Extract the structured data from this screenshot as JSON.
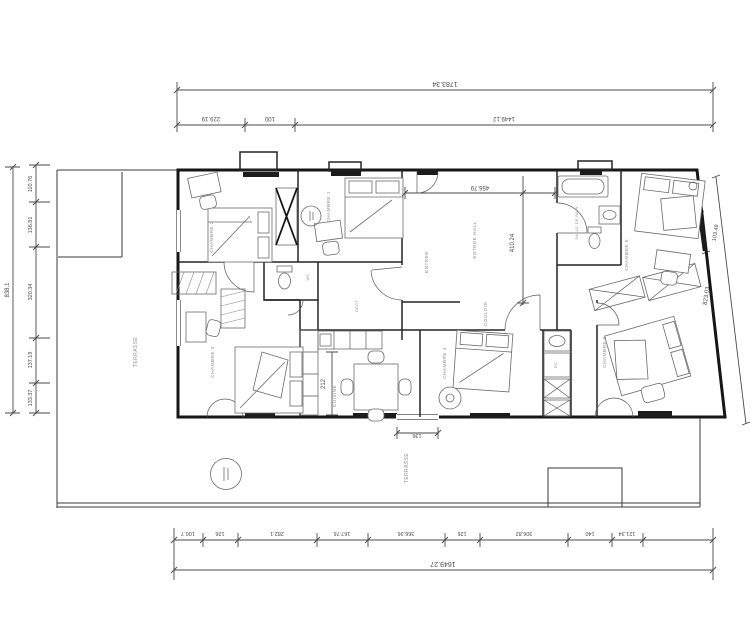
{
  "labels": {
    "terrasse": "TERRASSE",
    "chambre1": "CHAMBRE 1",
    "chambre2": "CHAMBRE 2",
    "chambre3": "CHAMBRE 3",
    "chambre4": "CHAMBRE 4",
    "chambre5": "CHAMBRE 5",
    "chambre6": "CHAMBRE 6",
    "entree": "ENTREE",
    "entree_hall": "ENTREE HALL",
    "salle_de_bain": "SALLE DE BAIN",
    "couloir": "COULOIR",
    "degagement": "DEGT",
    "cuisine": "CUISINE",
    "wc": "WC",
    "dc": "DC"
  },
  "dims": {
    "top": {
      "total": "1783.34",
      "seg1": "229.19",
      "seg2": "100",
      "seg3": "1449.12"
    },
    "left": {
      "total": "838.1",
      "seg1": "110.76",
      "seg2": "136.81",
      "seg3": "320.34",
      "seg4": "137.19",
      "seg5": "133.37"
    },
    "right": {
      "window": "103.48",
      "wall": "823.03"
    },
    "bottom": {
      "seg1": "100.7",
      "seg2": "126",
      "seg3": "282.1",
      "seg4": "167.76",
      "seg5": "366.36",
      "seg6": "126",
      "seg7": "306.82",
      "seg8": "140",
      "seg9": "121.34",
      "total": "1649.27"
    },
    "inner": {
      "hall_width": "456.79",
      "hall_depth": "410.24",
      "kitchen_width": "212",
      "door_width": "136"
    }
  }
}
